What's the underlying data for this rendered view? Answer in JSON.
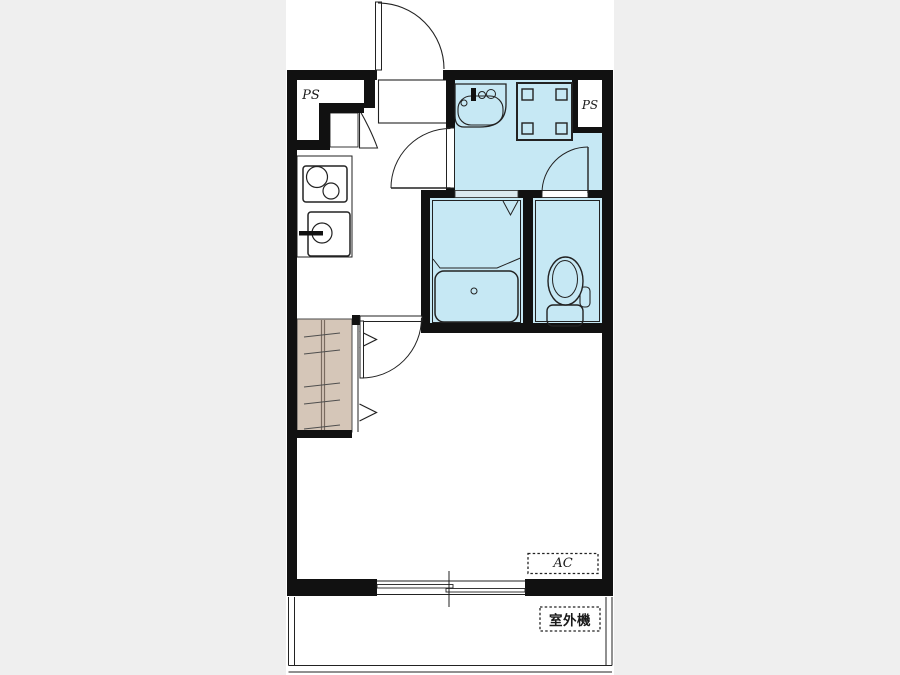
{
  "floorplan": {
    "labels": {
      "ps_left": "PS",
      "ps_right": "PS",
      "ac_unit": "AC",
      "outdoor_unit": "室外機"
    },
    "colors": {
      "wall": "#111111",
      "line": "#222222",
      "wet_area_fill": "#c6e8f4",
      "closet_fill": "#d5c6b8",
      "floor": "#ffffff",
      "background": "#efefef"
    }
  }
}
